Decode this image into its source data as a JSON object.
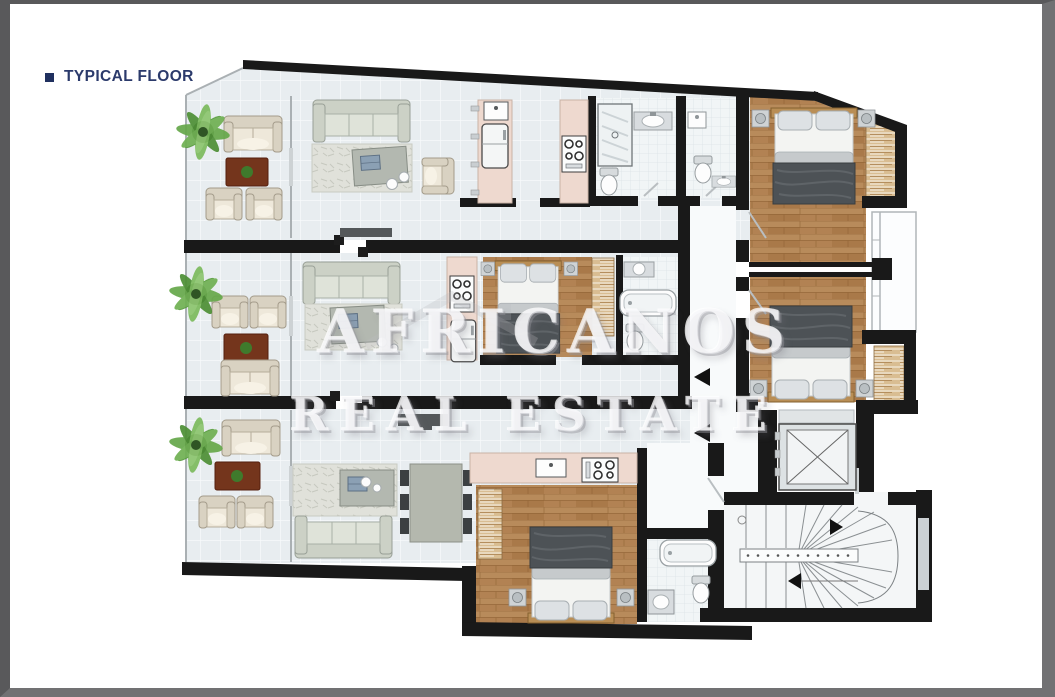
{
  "page": {
    "title": "TYPICAL FLOOR"
  },
  "watermark": {
    "line1": "AFRICANOS",
    "line2": "REAL ESTATE"
  },
  "plan": {
    "kind": "residential-typical-floor-plan",
    "units": [
      {
        "id": "apartment-1",
        "position": "top",
        "rooms": [
          "balcony",
          "living-room",
          "kitchen",
          "bathroom",
          "guest-toilet",
          "bedroom",
          "wardrobe"
        ]
      },
      {
        "id": "apartment-2",
        "position": "middle",
        "rooms": [
          "balcony",
          "living-room",
          "kitchen",
          "bedroom",
          "bathroom",
          "wardrobe"
        ]
      },
      {
        "id": "apartment-3",
        "position": "bottom",
        "rooms": [
          "balcony",
          "living-room",
          "dining-area",
          "kitchen",
          "bedroom",
          "bathroom"
        ]
      }
    ],
    "core": [
      "corridor",
      "elevator",
      "staircase"
    ],
    "colors": {
      "wall": "#191919",
      "floor_tile": "#e8edf0",
      "wood_floor": "#b28253",
      "kitchen_counter": "#eed9cf",
      "rug": "#74351c",
      "plant": "#5f9e44",
      "title": "#2b3a6b"
    }
  }
}
